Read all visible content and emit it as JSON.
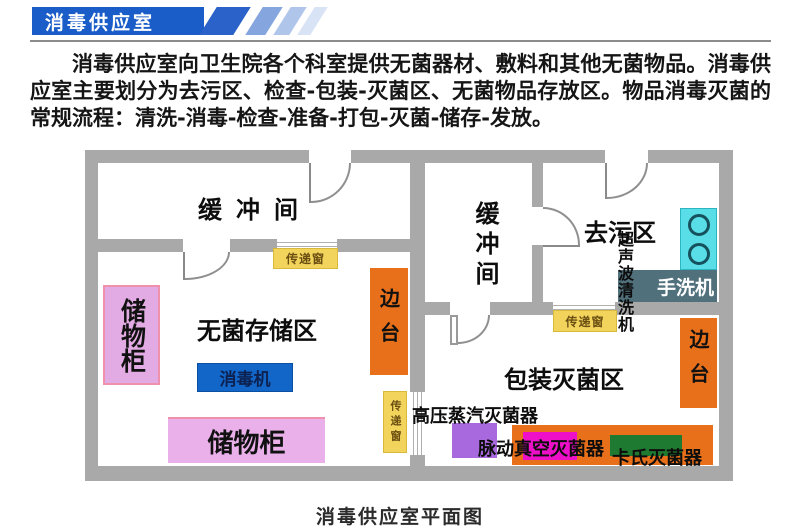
{
  "header": {
    "title": "消毒供应室"
  },
  "intro": "消毒供应室向卫生院各个科室提供无菌器材、敷料和其他无菌物品。消毒供应室主要划分为去污区、检查-包装-灭菌区、无菌物品存放区。物品消毒灭菌的常规流程：清洗-消毒-检查-准备-打包-灭菌-储存-发放。",
  "caption": "消毒供应室平面图",
  "plan": {
    "labels": {
      "buffer_room": "缓冲间",
      "decontamination_zone": "去污区",
      "sterile_storage_zone": "无菌存储区",
      "packing_sterilization_zone": "包装灭菌区",
      "cabinet": "储物柜",
      "disinfector": "消毒机",
      "side_table": "边台",
      "pass_window": "传递窗",
      "ultrasonic_cleaner": "超声波清洗机",
      "hand_washer": "手洗机",
      "steam_sterilizer": "高压蒸汽灭菌器",
      "pulse_vacuum_sterilizer": "脉动真空灭菌器",
      "cassette_sterilizer": "卡氏灭菌器"
    },
    "colors": {
      "wall_gray": "#a9a9a9",
      "header_blue": "#1a5cc8",
      "cabinet_pink": "#e3abe3",
      "side_table_orange": "#e8701a",
      "pass_window_yellow": "#f2d45c",
      "disinfector_blue": "#1266c8",
      "sink_cyan": "#59dde6",
      "hand_washer_slate": "#50707c",
      "steam_purple": "#a868de",
      "pulse_magenta": "#ee10c8",
      "cassette_green": "#1e7a30"
    }
  }
}
